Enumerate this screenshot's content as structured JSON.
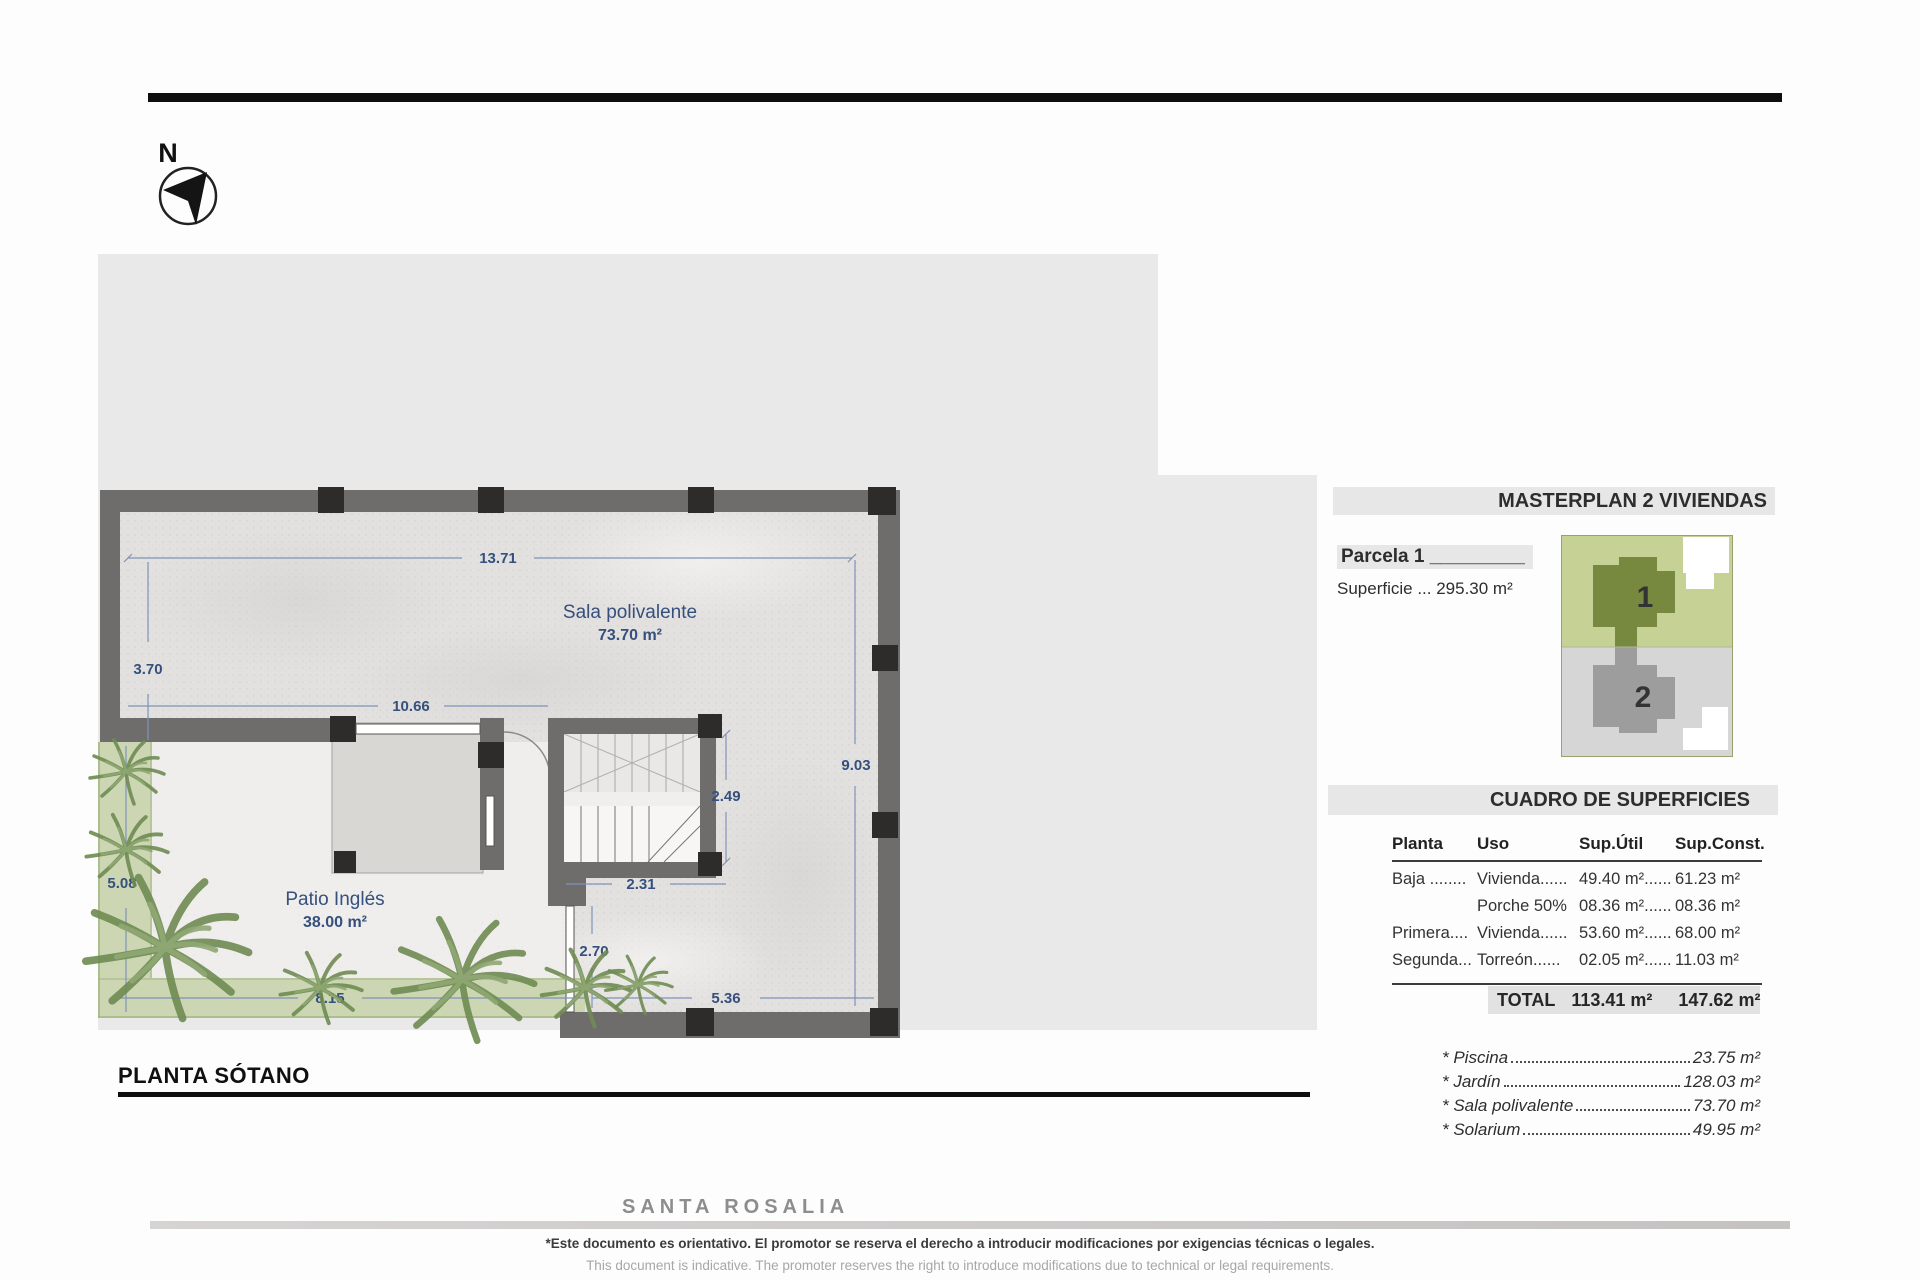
{
  "north": {
    "label": "N"
  },
  "plan": {
    "title": "PLANTA SÓTANO",
    "rooms": {
      "sala": {
        "name": "Sala polivalente",
        "area": "73.70 m²"
      },
      "patio": {
        "name": "Patio Inglés",
        "area": "38.00 m²"
      }
    },
    "dims": {
      "top": "13.71",
      "left_upper": "3.70",
      "middle": "10.66",
      "right": "9.03",
      "stair_height": "2.49",
      "stair_width": "2.31",
      "basement_window": "2.70",
      "garden_left": "5.08",
      "garden_bottom": "8.15",
      "bottom_right": "5.36"
    }
  },
  "masterplan": {
    "title": "MASTERPLAN 2 VIVIENDAS",
    "parcel_label": "Parcela 1 _________",
    "superficie": "Superficie ... 295.30 m²",
    "unit1": "1",
    "unit2": "2"
  },
  "table": {
    "title": "CUADRO DE SUPERFICIES",
    "headers": [
      "Planta",
      "Uso",
      "Sup.Útil",
      "Sup.Const."
    ],
    "rows": [
      [
        "Baja ........",
        "Vivienda......",
        "49.40 m²......",
        "61.23 m²"
      ],
      [
        "",
        "Porche 50%",
        "08.36 m²......",
        "08.36 m²"
      ],
      [
        "Primera....",
        "Vivienda......",
        "53.60 m²......",
        "68.00 m²"
      ],
      [
        "Segunda...",
        "Torreón......",
        "02.05 m²......",
        "11.03 m²"
      ]
    ],
    "total": {
      "label": "TOTAL",
      "util": "113.41 m²",
      "const": "147.62 m²"
    }
  },
  "extras": {
    "items": [
      {
        "name": "* Piscina",
        "value": "23.75 m²"
      },
      {
        "name": "* Jardín",
        "value": "128.03 m²"
      },
      {
        "name": "* Sala polivalente",
        "value": "73.70 m²"
      },
      {
        "name": "* Solarium",
        "value": "49.95 m²"
      }
    ]
  },
  "watermark": "SANTA ROSALIA",
  "footer": {
    "line1": "*Este documento es orientativo. El promotor se reserva el derecho a introducir modificaciones por exigencias técnicas o legales.",
    "line2": "This document is indicative. The promoter reserves the right to introduce modifications due to technical or legal requirements."
  },
  "colors": {
    "wall": "#6f6d6b",
    "column": "#2e2c2a",
    "parcel_bg": "#e9e9e9",
    "dim_blue": "#35507c",
    "garden_green": "#ccd6b3",
    "mp_green": "#c6d295",
    "mp_house1": "#77883f",
    "mp_gray": "#d6d6d6",
    "mp_house2": "#9d9d9d"
  }
}
